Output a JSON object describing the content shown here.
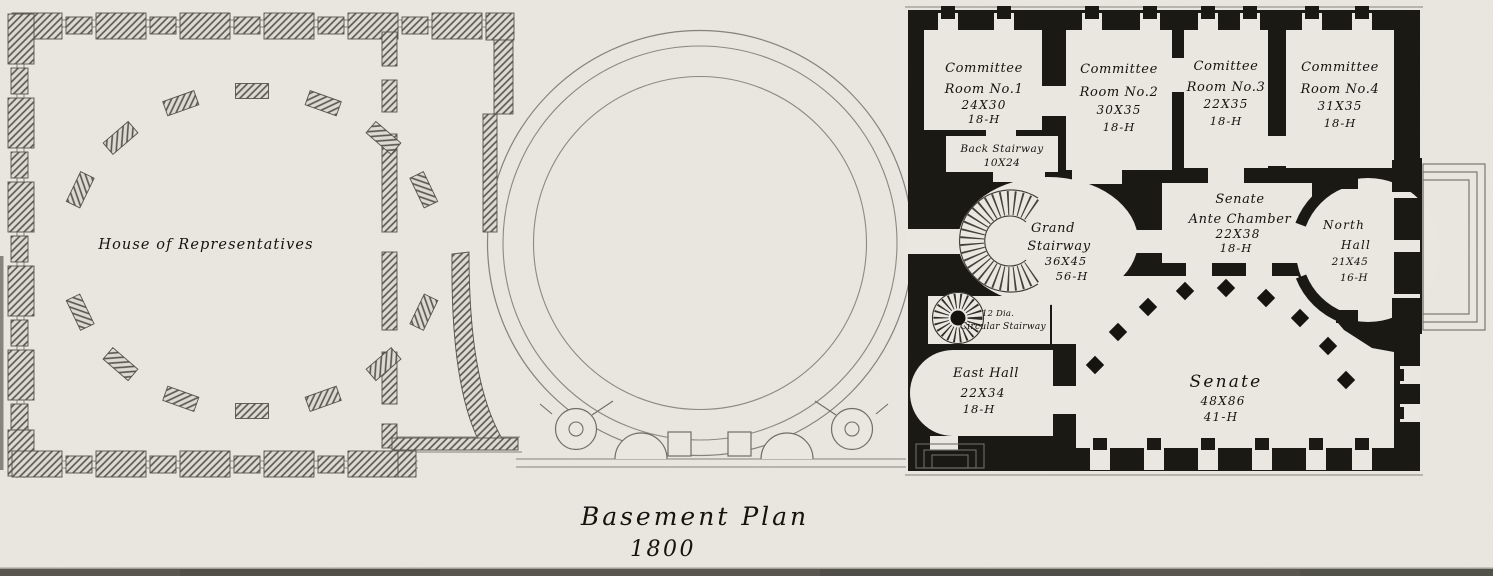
{
  "plan": {
    "title": "Basement Plan",
    "year": "1800",
    "house_wing": {
      "label": "House of Representatives"
    },
    "senate_wing": {
      "committee_room_1": {
        "name1": "Committee",
        "name2": "Room No.1",
        "size": "24X30",
        "height": "18-H"
      },
      "committee_room_2": {
        "name1": "Committee",
        "name2": "Room No.2",
        "size": "30X35",
        "height": "18-H"
      },
      "committee_room_3": {
        "name1": "Comittee",
        "name2": "Room No.3",
        "size": "22X35",
        "height": "18-H"
      },
      "committee_room_4": {
        "name1": "Committee",
        "name2": "Room No.4",
        "size": "31X35",
        "height": "18-H"
      },
      "back_stairway": {
        "name": "Back Stairway",
        "size": "10X24"
      },
      "grand_stairway": {
        "name1": "Grand",
        "name2": "Stairway",
        "size": "36X45",
        "height": "56-H"
      },
      "senate_ante_chamber": {
        "name1": "Senate",
        "name2": "Ante Chamber",
        "size": "22X38",
        "height": "18-H"
      },
      "north_hall": {
        "name1": "North",
        "name2": "Hall",
        "size": "21X45",
        "height": "16-H"
      },
      "east_hall": {
        "name": "East Hall",
        "size": "22X34",
        "height": "18-H"
      },
      "circular_stairway": {
        "line1": "12 Dia.",
        "line2": "Circular Stairway"
      },
      "senate_chamber": {
        "name": "Senate",
        "size": "48X86",
        "height": "41-H"
      }
    },
    "colors": {
      "paper": "#e9e7e0",
      "ink": "#1a1913"
    }
  }
}
